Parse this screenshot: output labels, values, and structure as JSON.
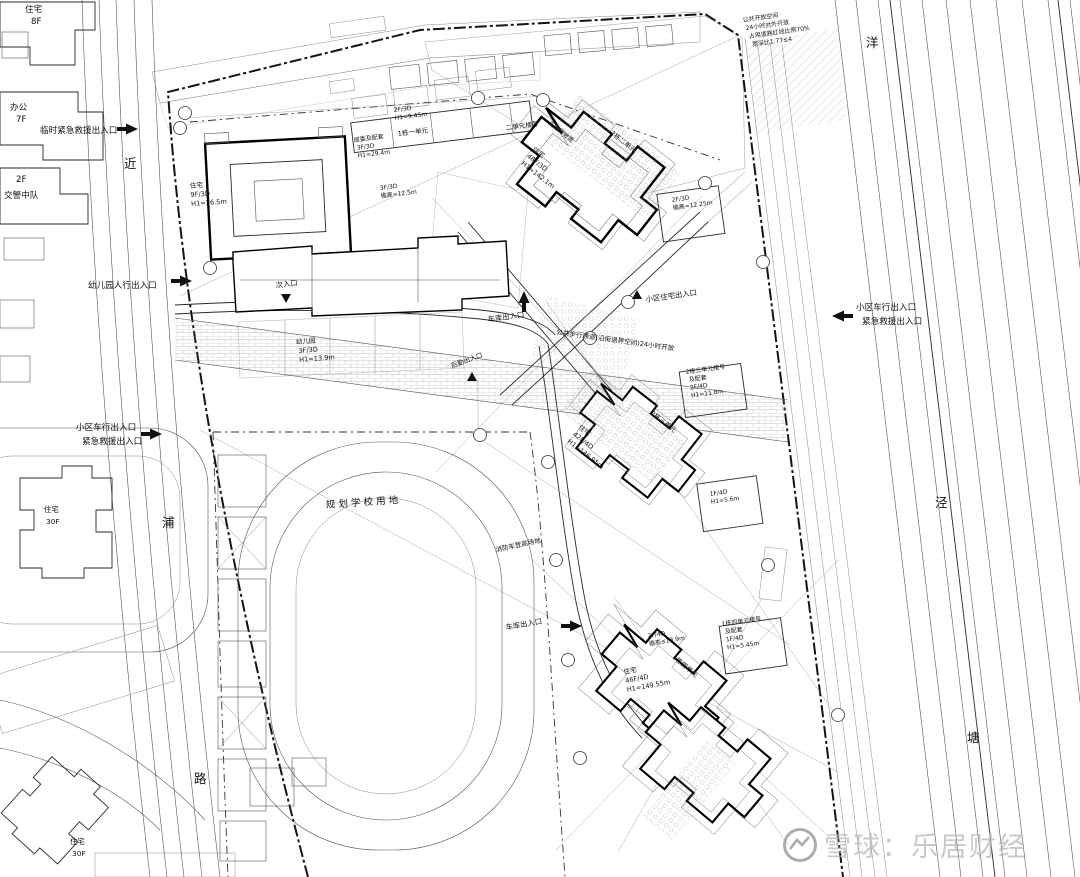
{
  "adjacent": {
    "res8f_name": "住宅",
    "res8f_floors": "8F",
    "office_name": "办公",
    "office_floors": "7F",
    "police_floors": "2F",
    "police_name": "交警中队",
    "res30fa_name": "住宅",
    "res30fa_floors": "30F",
    "res30fb_name": "住宅",
    "res30fb_floors": "30F"
  },
  "roads": {
    "left_chars": [
      "近",
      "浦",
      "路"
    ],
    "right_chars": [
      "洋",
      "泾",
      "塘"
    ]
  },
  "entrances": {
    "temp_rescue": "临时紧急救援出入口",
    "kg_ped": "幼儿园人行出入口",
    "west_vehicle_l1": "小区车行出入口",
    "west_vehicle_l2": "紧急救援出入口",
    "east_vehicle_l1": "小区车行出入口",
    "east_vehicle_l2": "紧急救援出入口",
    "garage_west": "车库出入口",
    "garage_south": "车库出入口",
    "secondary": "次入口",
    "resident": "小区住宅出入口",
    "logistics": "后勤出入口"
  },
  "notes": {
    "walkway": "公共步行通道(沿街退界空间)24小时开放",
    "fire_zone": "消防车登高场地",
    "open_l1": "公共开放空间",
    "open_l2": "24小时对外开放",
    "open_l3": "占用道路红线比例70%",
    "open_l4": "宽深比1.77≤4",
    "school": "规划学校用地",
    "ramp": "无障碍坡道"
  },
  "buildings": {
    "b1_name": "住宅",
    "b1_spec": "9F/3D",
    "b1_h": "H1≈26.5m",
    "b1_unit": "1栋一单元",
    "unit2_sign": "二单元楼号",
    "b1_roof_spec": "2F/3D",
    "b1_roof_h": "H1≈9.45m",
    "annex_name": "居委及配套",
    "annex_spec": "3F/3D",
    "annex_h": "H1≈29.4m",
    "podium_spec": "3F/3D",
    "podium_h": "檐高≈12.5m",
    "kg_name": "幼儿园",
    "kg_spec": "3F/3D",
    "kg_h": "H1≈13.9m",
    "t1_name": "住宅",
    "t1_spec": "48F/3D",
    "t1_h": "H1≈142.1m",
    "t1_unit": "2栋二单元",
    "t1_pod_spec": "2F/3D",
    "t1_pod_h": "檐高≈12.25m",
    "t2_name": "住宅",
    "t2_spec": "42F/4D",
    "t2_h": "H1≈146.95m",
    "t2_unit": "2栋三单元",
    "t2_annex_l1": "2栋三单元楼号",
    "t2_annex_l2": "及配套",
    "t2_annex_l3": "2F/4D",
    "t2_annex_l4": "H1≈11.8m",
    "t2_side_spec": "1F/4D",
    "t2_side_h": "H1≈5.6m",
    "t3_name": "住宅",
    "t3_spec": "46F/4D",
    "t3_h": "H1≈149.55m",
    "t3_unit": "1栋四单元",
    "t3_eave_spec": "2F/4D",
    "t3_eave_h": "檐高≤13.9m",
    "t3_annex_l1": "1栋四单元楼号",
    "t3_annex_l2": "及配套",
    "t3_annex_l3": "1F/4D",
    "t3_annex_l4": "H1≈5.45m"
  },
  "watermark": {
    "brand": "雪球：乐居财经"
  }
}
